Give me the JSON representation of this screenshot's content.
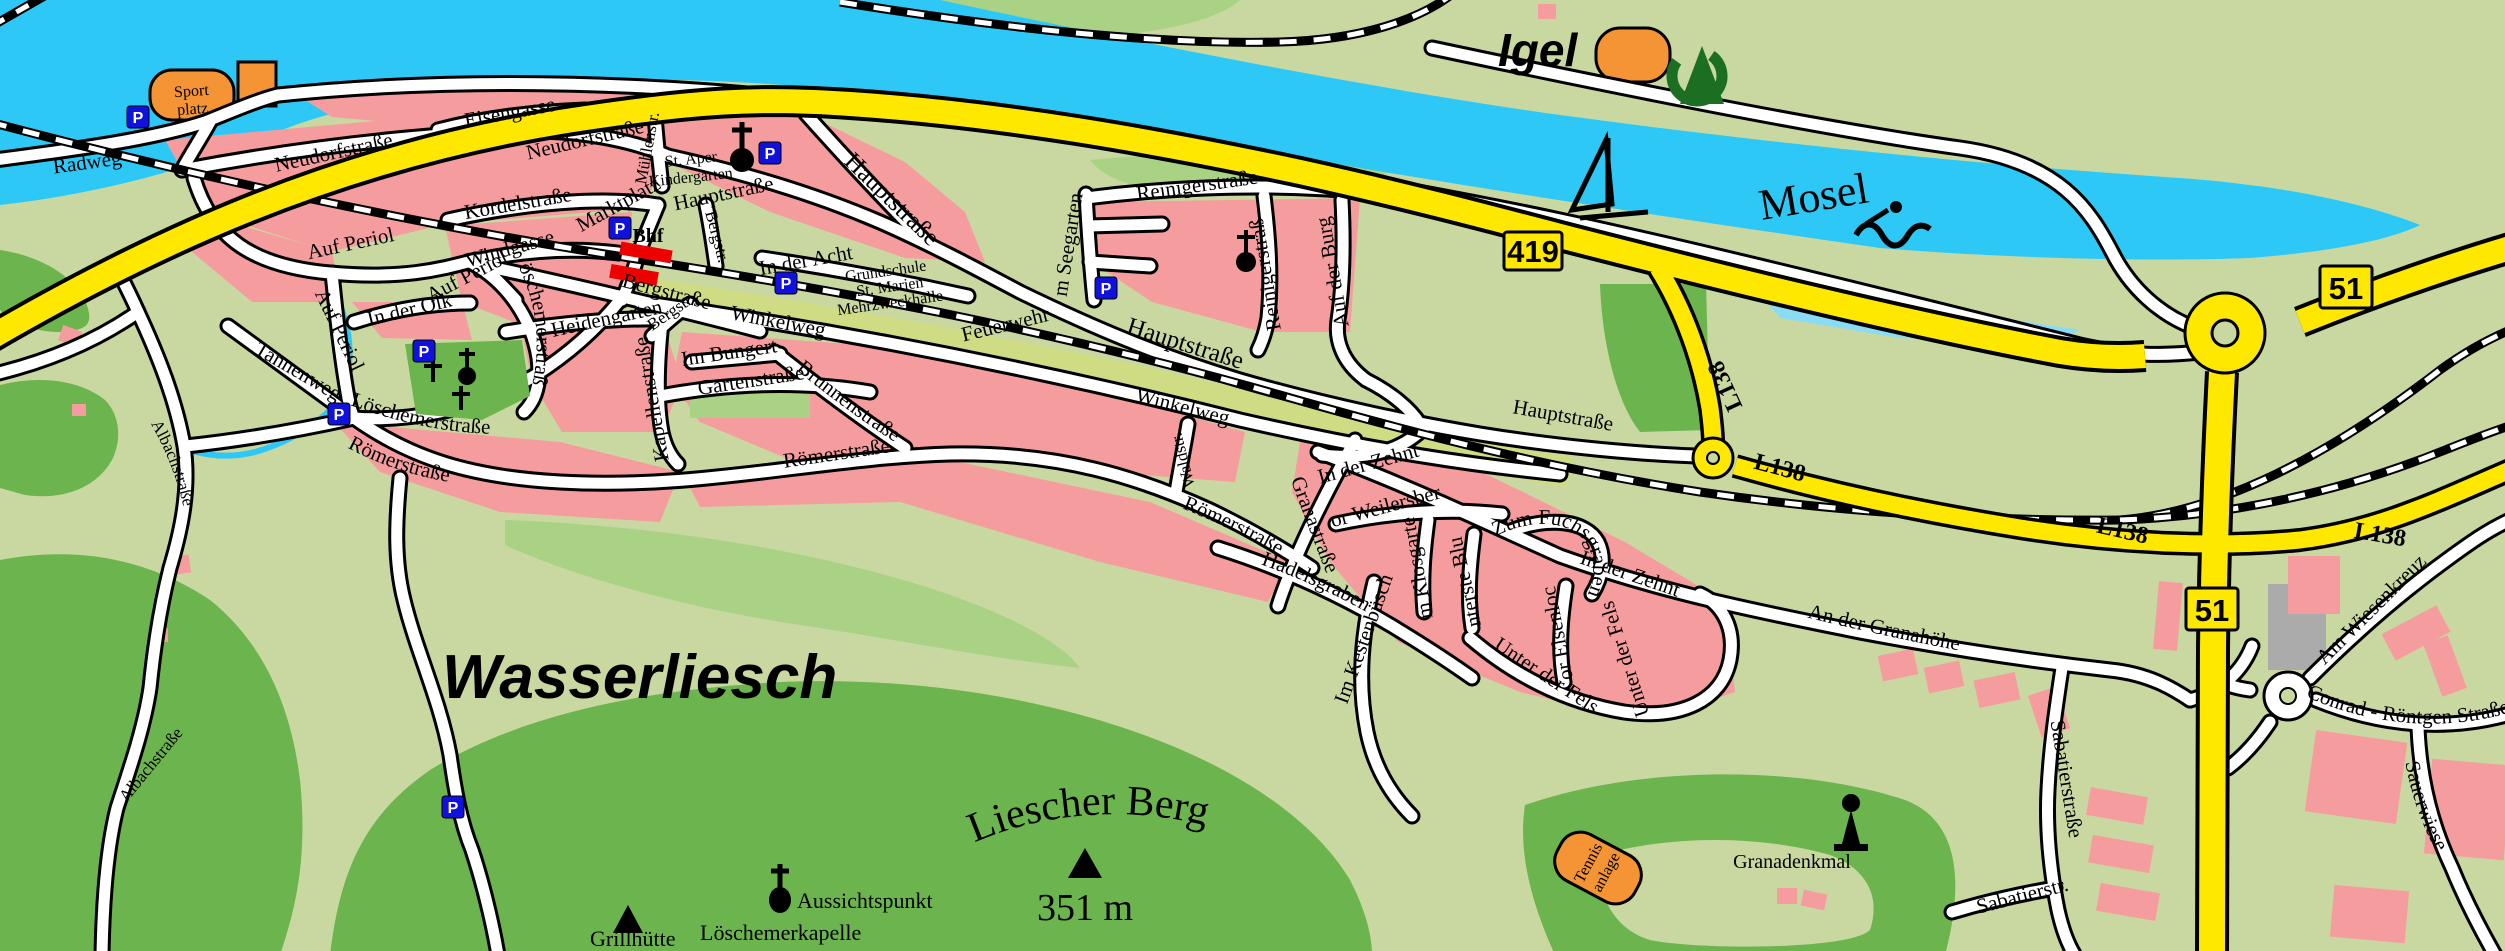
{
  "colors": {
    "field": "#c9d8a1",
    "forest": "#6cb44e",
    "light_green": "#a9d284",
    "water": "#2ec8f7",
    "shallow_water": "#8adcf5",
    "residential": "#f59d9e",
    "main_road": "#ffe800",
    "minor_road": "#ffffff",
    "rail_median": "#cfdc84",
    "station_red": "#ec0000",
    "poi_orange": "#f49434",
    "parking_blue": "#1111dd",
    "campground_green": "#1c6e22",
    "building_gray": "#ababab"
  },
  "places": {
    "town": "Wasserliesch",
    "neighbor_village": "Igel",
    "river": "Mosel",
    "hill": "Liescher Berg",
    "hill_elevation": "351 m"
  },
  "signs": {
    "b419": "419",
    "b51": "51",
    "l138": "L138"
  },
  "pois": {
    "sportplatz_line1": "Sport",
    "sportplatz_line2": "platz",
    "kindergarten_line1": "St. Aper",
    "kindergarten_line2": "Kindergarten",
    "school_line1": "Grundschule",
    "school_line2": "St. Marien",
    "school_line3": "Mehrzweckhalle",
    "fire_station": "Feuerwehr",
    "station": "Bhf",
    "viewpoint": "Aussichtspunkt",
    "chapel": "Löschemerkapelle",
    "bbq_hut": "Grillhütte",
    "monument": "Granadenkmal",
    "tennis_line1": "Tennis",
    "tennis_line2": "anlage",
    "parking_letter": "P"
  },
  "streets": [
    {
      "name": "Radweg"
    },
    {
      "name": "Eisengasse"
    },
    {
      "name": "Neudorfstraße"
    },
    {
      "name": "Neudorfstraße"
    },
    {
      "name": "Kordelstraße"
    },
    {
      "name": "Windgasse"
    },
    {
      "name": "Auf Periol"
    },
    {
      "name": "Auf Periol"
    },
    {
      "name": "Auf Periol"
    },
    {
      "name": "In der Olk"
    },
    {
      "name": "Tannenweg"
    },
    {
      "name": "Löschemerstraße"
    },
    {
      "name": "Löschemerstraße"
    },
    {
      "name": "Römerstraße"
    },
    {
      "name": "Römerstraße"
    },
    {
      "name": "Römerstraße"
    },
    {
      "name": "Heidengarten"
    },
    {
      "name": "Bergstraße"
    },
    {
      "name": "Bergstr."
    },
    {
      "name": "Bergstr."
    },
    {
      "name": "Mühlenstr."
    },
    {
      "name": "Marktplatz"
    },
    {
      "name": "Hauptstraße"
    },
    {
      "name": "Hauptstraße"
    },
    {
      "name": "Hauptstraße"
    },
    {
      "name": "Hauptstraße"
    },
    {
      "name": "In der Acht"
    },
    {
      "name": "Winkelweg"
    },
    {
      "name": "Winkelweg"
    },
    {
      "name": "Im Bungert"
    },
    {
      "name": "Brunnenstraße"
    },
    {
      "name": "Gartenstraße"
    },
    {
      "name": "Kapellenstraße"
    },
    {
      "name": "Im Seegarten"
    },
    {
      "name": "Reinigerstraße"
    },
    {
      "name": "Reinigerstraße"
    },
    {
      "name": "Auf der Burg"
    },
    {
      "name": "Waldstr."
    },
    {
      "name": "Granastraße"
    },
    {
      "name": "In der Zehnt"
    },
    {
      "name": "In der Zehnt"
    },
    {
      "name": "Vor Weilersberg"
    },
    {
      "name": "Zum Fuchsgraben"
    },
    {
      "name": "Im Klosgarten"
    },
    {
      "name": "Unterste Blum"
    },
    {
      "name": "Vor Elsenloch"
    },
    {
      "name": "Unter der Fels"
    },
    {
      "name": "Unter der Fels"
    },
    {
      "name": "Im Kestenbüsch"
    },
    {
      "name": "Hadelsgraben"
    },
    {
      "name": "An der Granahöhe"
    },
    {
      "name": "Sabatierstraße"
    },
    {
      "name": "Sabatierstr."
    },
    {
      "name": "Am Wiesenkreuz"
    },
    {
      "name": "Conrad - Röntgen Straße"
    },
    {
      "name": "Sauerwiese"
    },
    {
      "name": "Albachstraße"
    },
    {
      "name": "Albachstraße"
    }
  ]
}
